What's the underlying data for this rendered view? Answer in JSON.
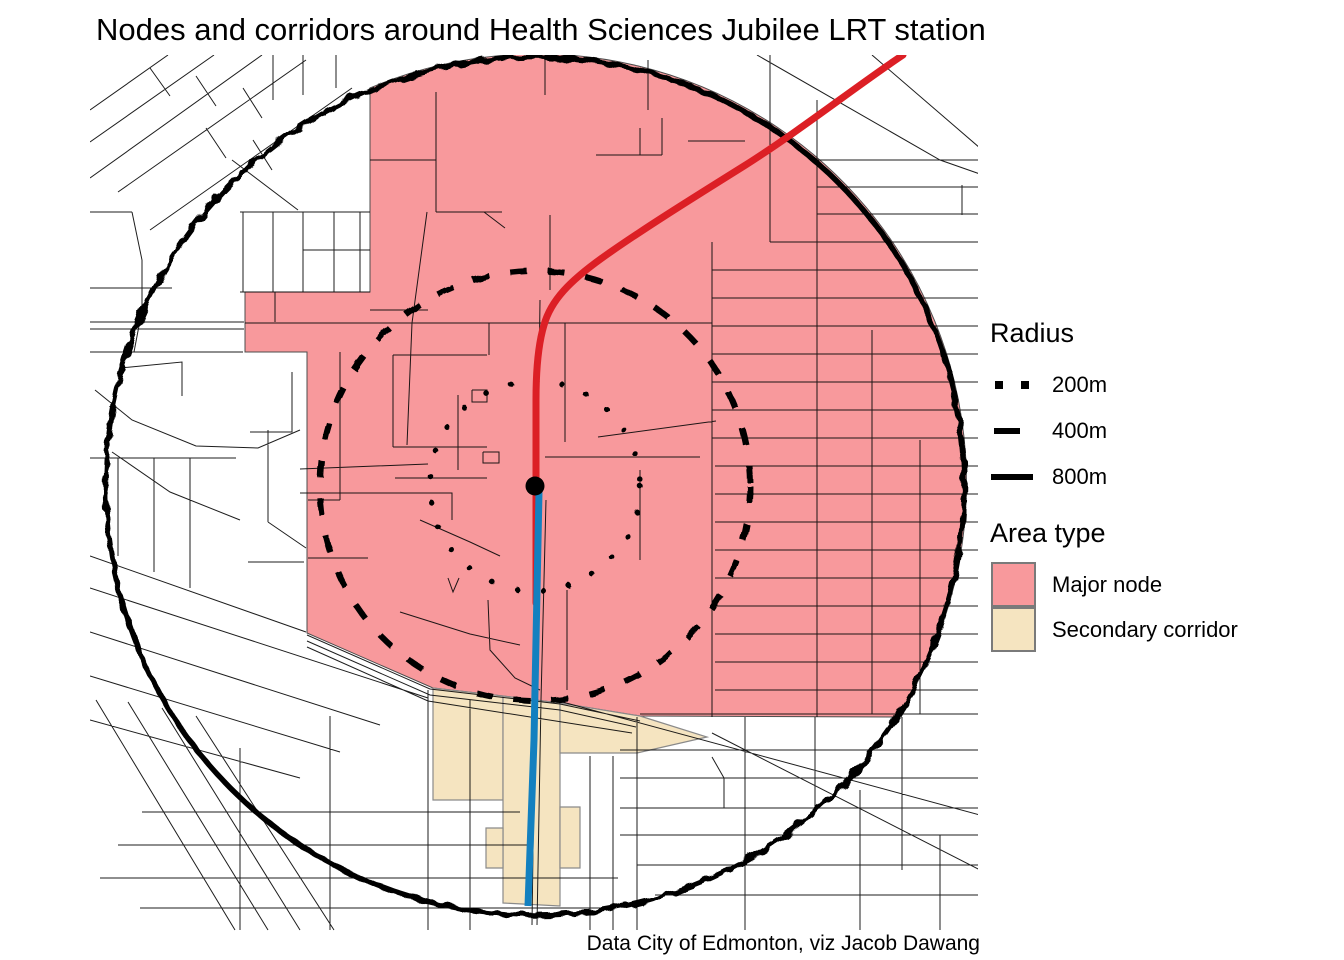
{
  "title": "Nodes and corridors around Health Sciences Jubilee LRT station",
  "caption": "Data City of Edmonton, viz Jacob Dawang",
  "legend": {
    "radius": {
      "title": "Radius",
      "items": [
        {
          "label": "200m",
          "line_style": "dotted"
        },
        {
          "label": "400m",
          "line_style": "dashed"
        },
        {
          "label": "800m",
          "line_style": "solid"
        }
      ]
    },
    "area_type": {
      "title": "Area type",
      "items": [
        {
          "label": "Major node",
          "color": "#F8999C"
        },
        {
          "label": "Secondary corridor",
          "color": "#F5E4C0"
        }
      ]
    }
  },
  "map": {
    "station_marker": "black-dot",
    "radii_m": [
      200,
      400,
      800
    ],
    "colors": {
      "major_node": "#F8999C",
      "secondary_corridor": "#F5E4C0",
      "lrt_line": "#DC1F25",
      "south_corridor_line": "#1380BF",
      "radius_rings": "#000000",
      "streets": "#0a0a0a"
    }
  }
}
